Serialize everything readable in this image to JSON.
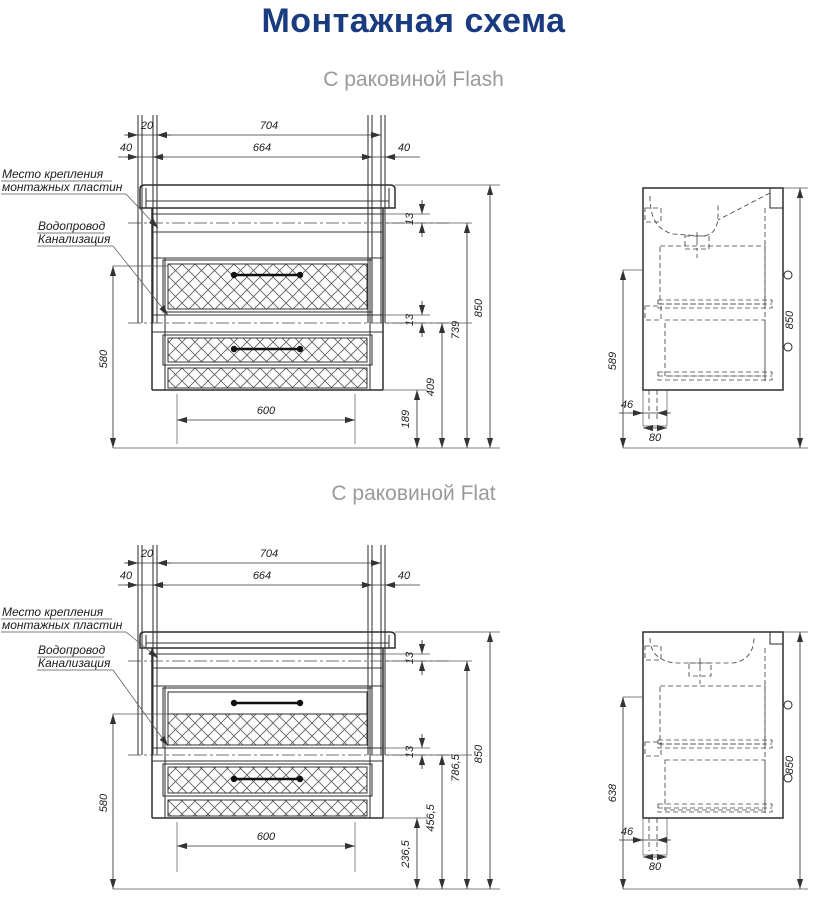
{
  "page": {
    "title": "Монтажная схема",
    "title_color": "#1a3b80",
    "background": "#ffffff"
  },
  "annotations": {
    "mount_plate_line1": "Место крепления",
    "mount_plate_line2": "монтажных пластин",
    "plumbing_line1": "Водопровод",
    "plumbing_line2": "Канализация"
  },
  "sections": [
    {
      "subtitle": "С раковиной Flash",
      "front": {
        "dim_20": "20",
        "dim_704": "704",
        "dim_40_left": "40",
        "dim_664": "664",
        "dim_40_right": "40",
        "dim_580": "580",
        "dim_600": "600",
        "dim_13_top": "13",
        "dim_13_mid": "13",
        "dim_r1": "189",
        "dim_r2": "409",
        "dim_r3": "739",
        "dim_850": "850"
      },
      "side": {
        "dim_height": "589",
        "dim_46": "46",
        "dim_80": "80",
        "dim_850": "850"
      }
    },
    {
      "subtitle": "С раковиной Flat",
      "front": {
        "dim_20": "20",
        "dim_704": "704",
        "dim_40_left": "40",
        "dim_664": "664",
        "dim_40_right": "40",
        "dim_580": "580",
        "dim_600": "600",
        "dim_13_top": "13",
        "dim_13_mid": "13",
        "dim_r1": "236,5",
        "dim_r2": "456,5",
        "dim_r3": "786,5",
        "dim_850": "850"
      },
      "side": {
        "dim_height": "638",
        "dim_46": "46",
        "dim_80": "80",
        "dim_850": "850"
      }
    }
  ]
}
